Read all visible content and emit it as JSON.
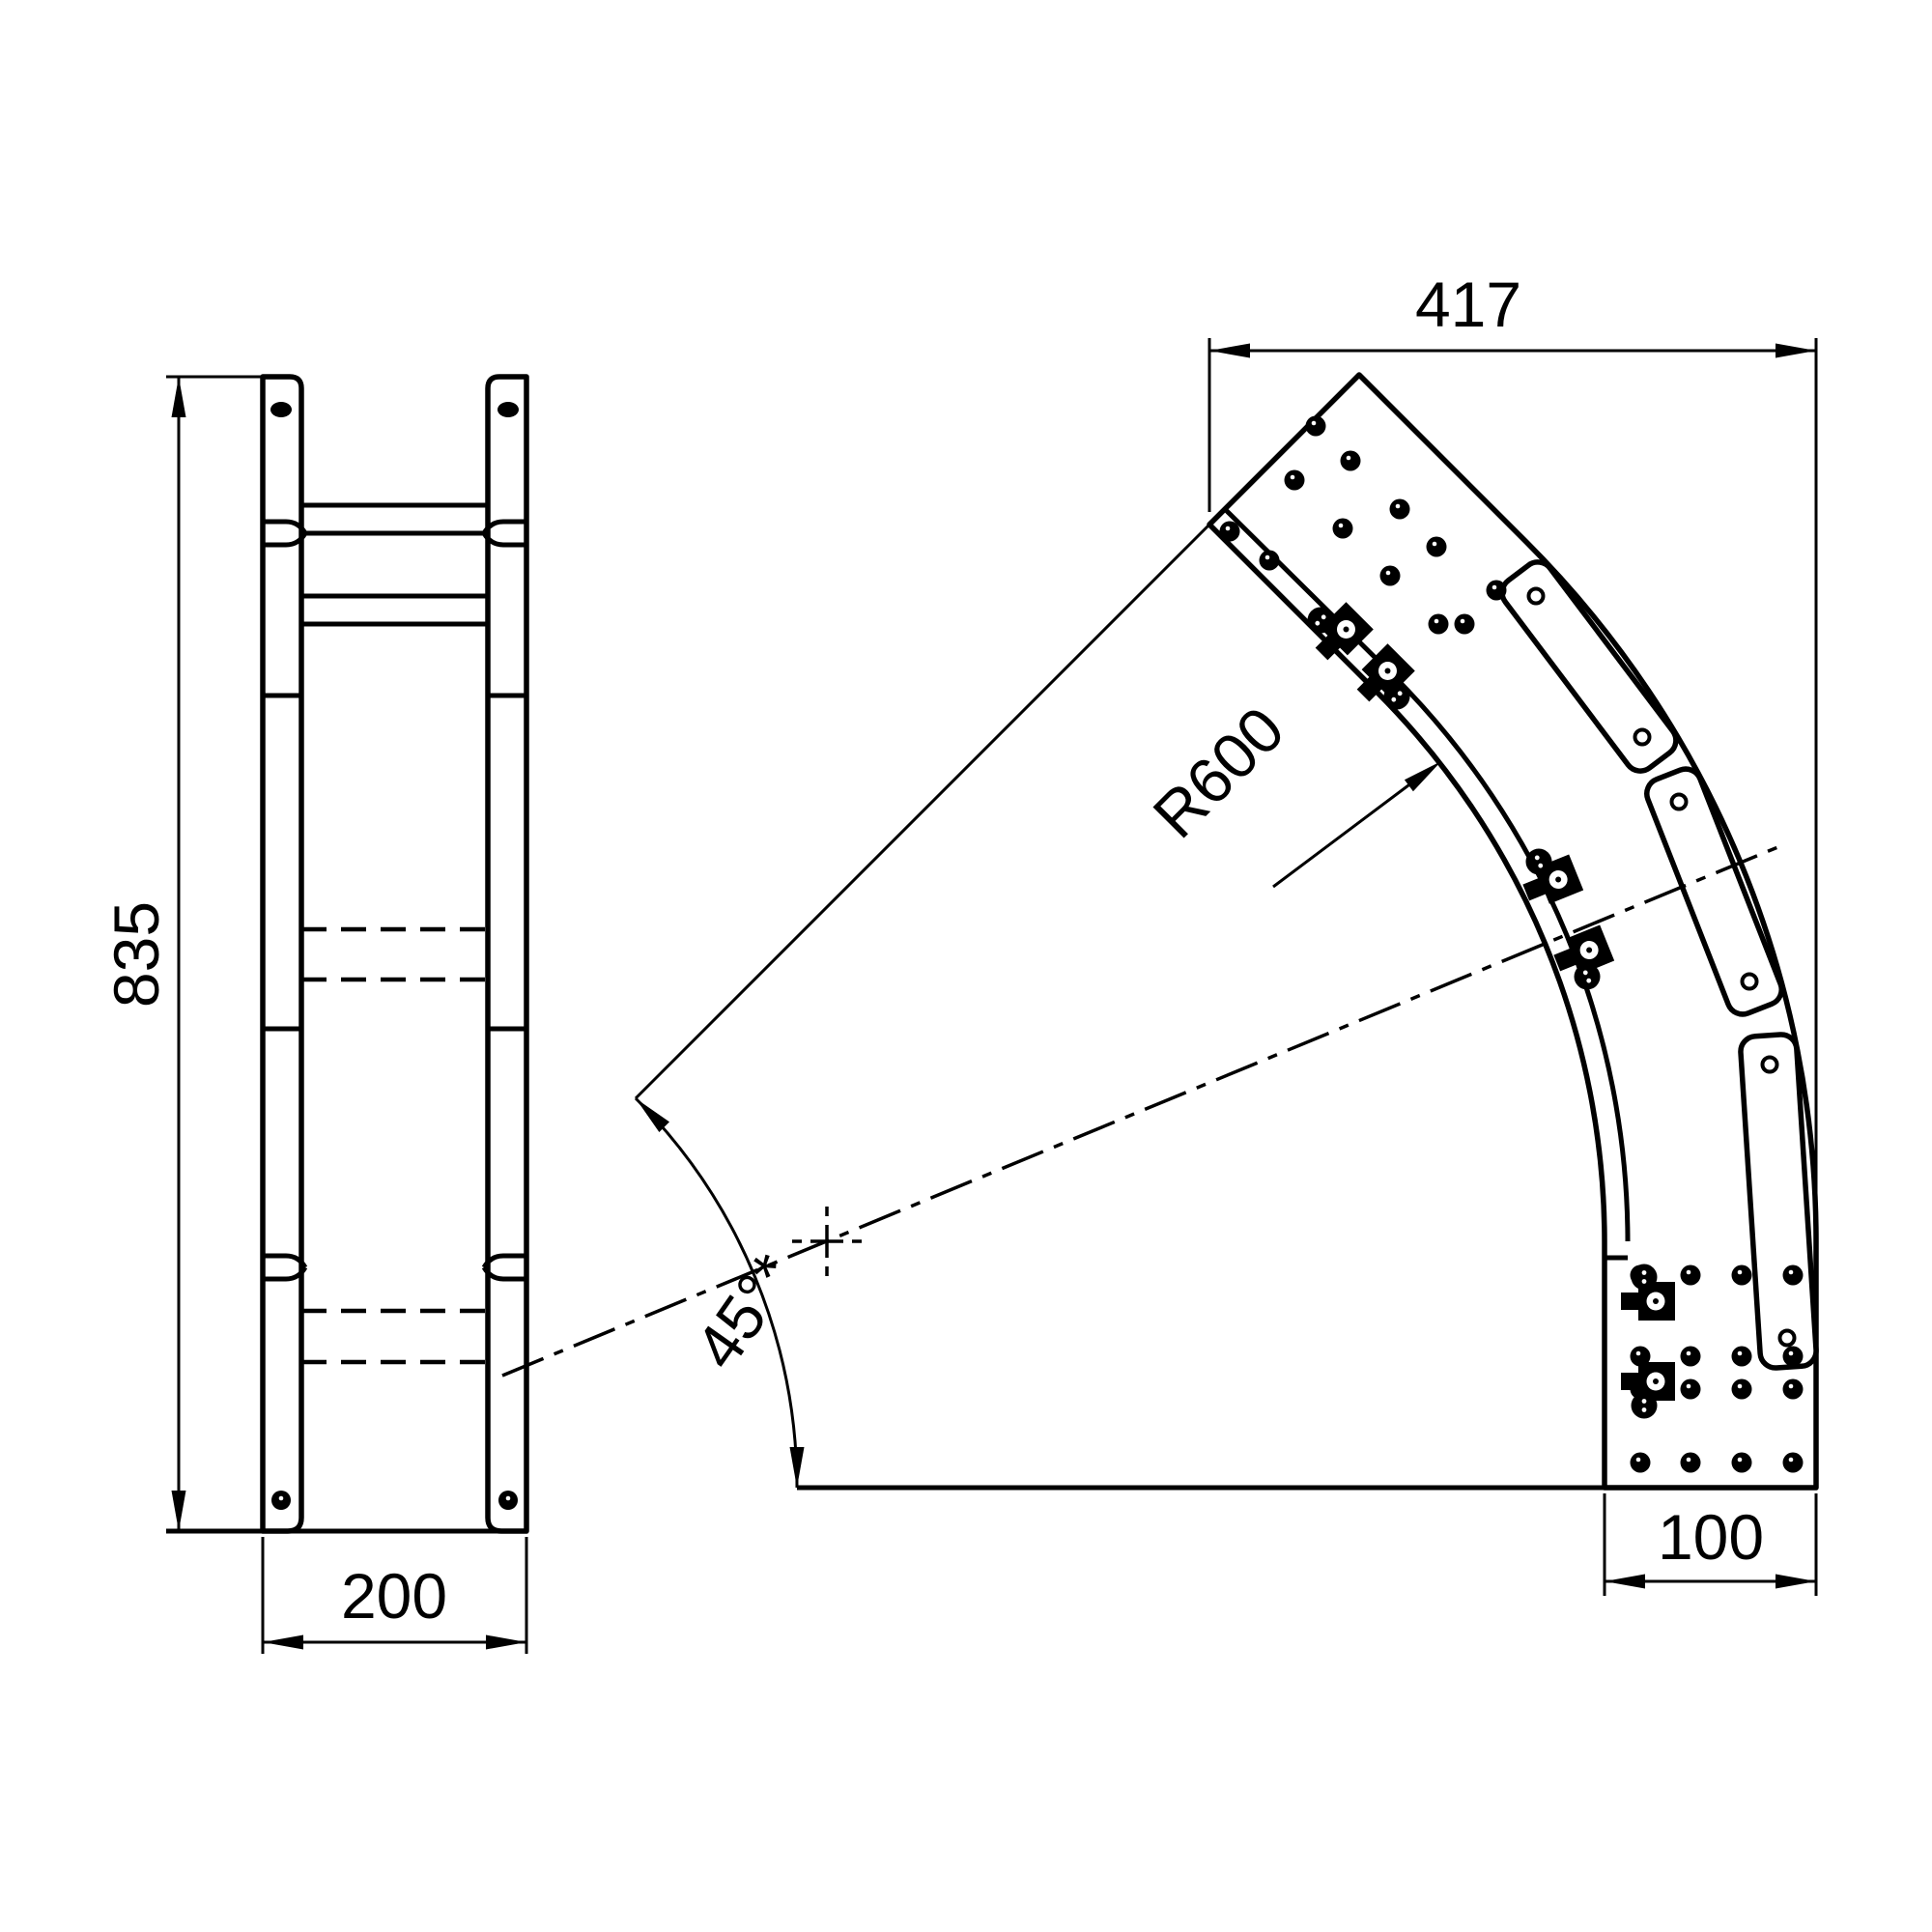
{
  "page": {
    "background": "#ffffff",
    "line_color": "#000000"
  },
  "front_view": {
    "dim_height": "835",
    "dim_width": "200"
  },
  "plan_view": {
    "dim_span": "417",
    "dim_end_width": "100",
    "dim_radius": "R600",
    "dim_angle": "45°*"
  }
}
